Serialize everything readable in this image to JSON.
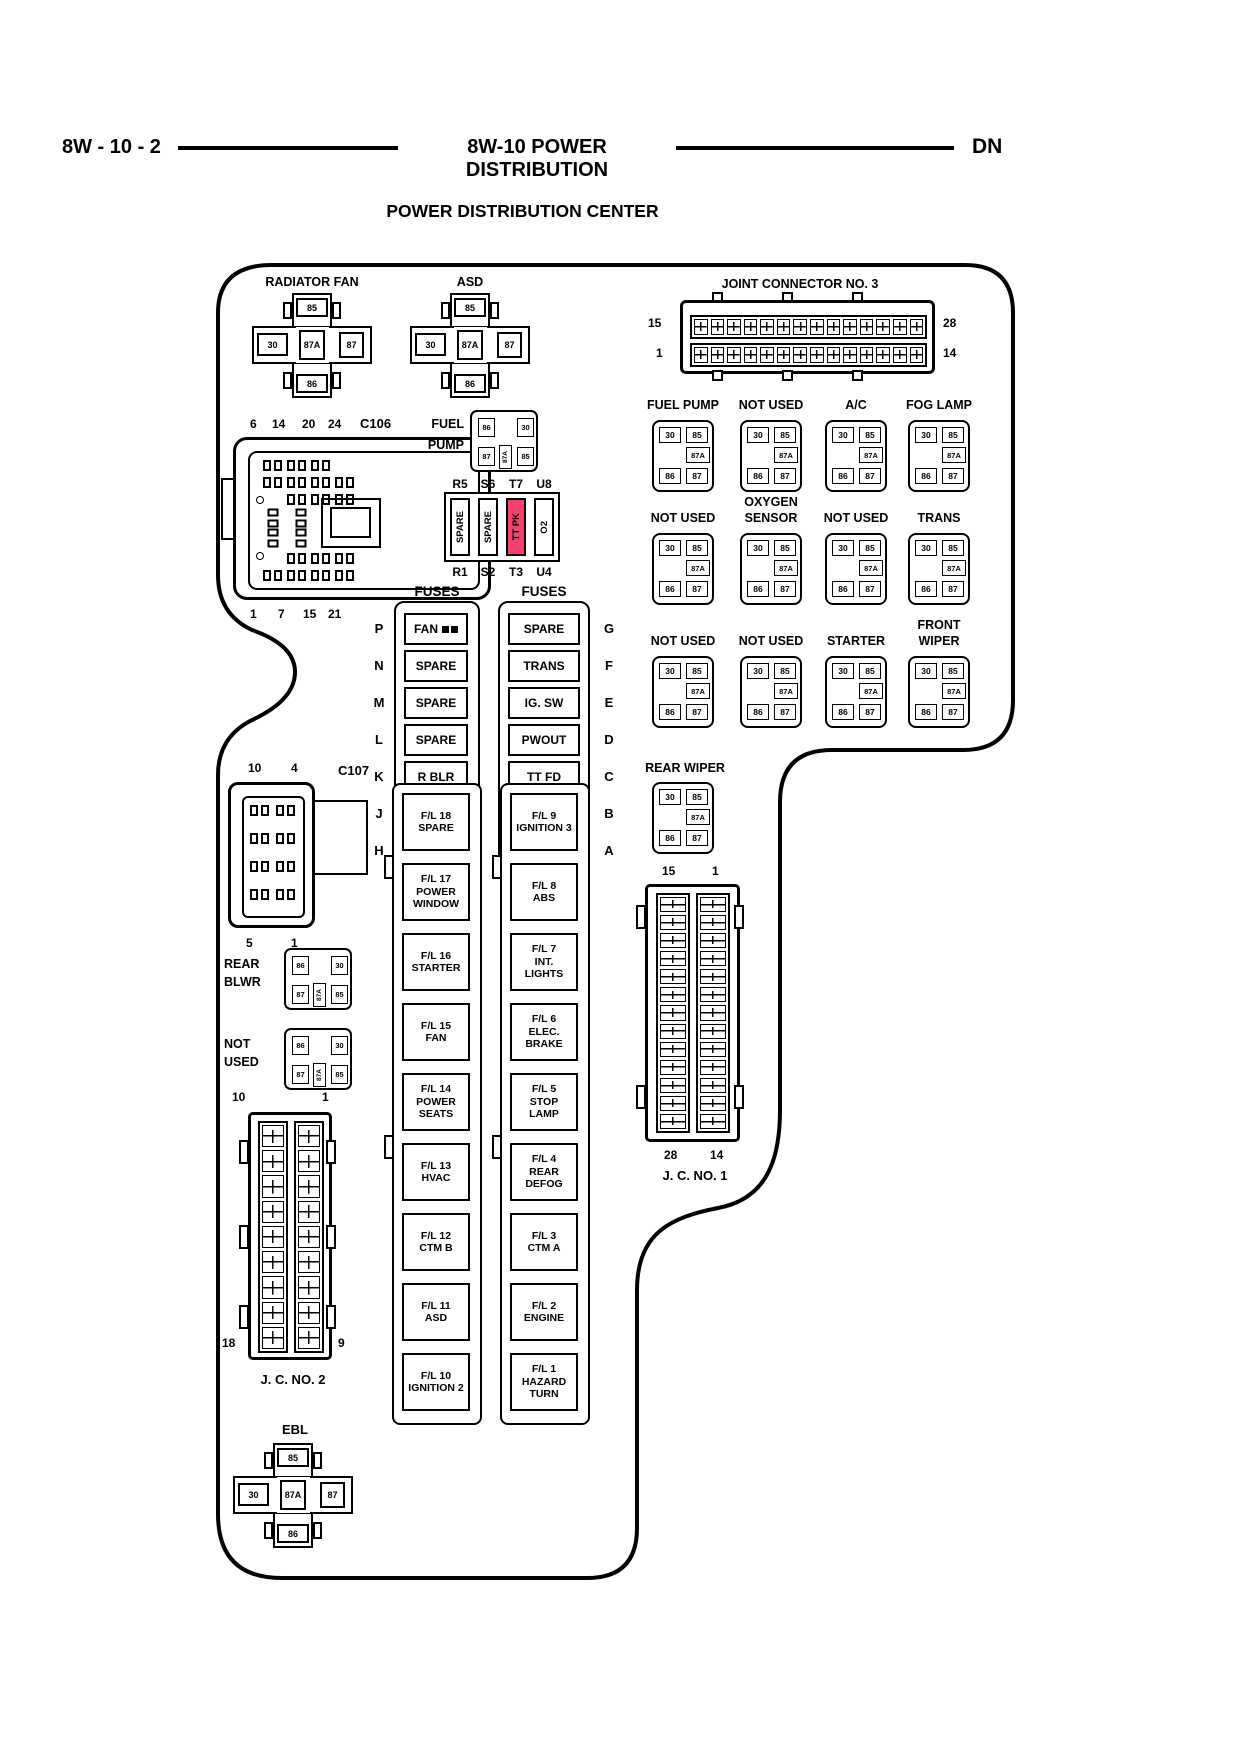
{
  "header": {
    "left_code": "8W - 10 - 2",
    "center_title": "8W-10 POWER DISTRIBUTION",
    "right_code": "DN"
  },
  "title": "POWER DISTRIBUTION CENTER",
  "colors": {
    "highlight_pink": "#f4426e"
  },
  "pins_big": {
    "p85": "85",
    "p30": "30",
    "p87a": "87A",
    "p87": "87",
    "p86": "86"
  },
  "pins_small": {
    "p30": "30",
    "p85": "85",
    "p87a": "87A",
    "p86": "86",
    "p87": "87"
  },
  "pins_mini": {
    "p86": "86",
    "p30": "30",
    "p87": "87",
    "p87a": "87A",
    "p85": "85"
  },
  "big_relays": {
    "radiator_fan": "RADIATOR FAN",
    "asd": "ASD",
    "ebl": "EBL"
  },
  "jc3": {
    "label": "JOINT CONNECTOR NO. 3",
    "top_left": "15",
    "bottom_left": "1",
    "top_right": "28",
    "bottom_right": "14"
  },
  "jc1": {
    "label": "J. C. NO. 1",
    "top_left": "15",
    "top_right": "1",
    "bottom_left": "28",
    "bottom_right": "14"
  },
  "jc2": {
    "label": "J. C. NO. 2",
    "top_left": "10",
    "top_right": "1",
    "bottom_left": "18",
    "bottom_right": "9"
  },
  "c106": {
    "label": "C106",
    "top_pins": [
      "6",
      "14",
      "20",
      "24"
    ],
    "bottom_pins": [
      "1",
      "7",
      "15",
      "21"
    ]
  },
  "c107": {
    "label": "C107",
    "top_pins": [
      "10",
      "4"
    ],
    "bottom_pins": [
      "5",
      "1"
    ]
  },
  "fuel_pump": {
    "line1": "FUEL",
    "line2": "PUMP"
  },
  "rear_blwr": {
    "line1": "REAR",
    "line2": "BLWR"
  },
  "not_used_mini": {
    "line1": "NOT",
    "line2": "USED"
  },
  "mini_strip": {
    "top": [
      "R5",
      "S6",
      "T7",
      "U8"
    ],
    "bottom": [
      "R1",
      "S2",
      "T3",
      "U4"
    ],
    "fuses": [
      "SPARE",
      "SPARE",
      "TT PK",
      "O2"
    ]
  },
  "fuse_columns": {
    "left": {
      "header": "FUSES",
      "rows": [
        {
          "pos": "P",
          "label": "FAN"
        },
        {
          "pos": "N",
          "label": "SPARE"
        },
        {
          "pos": "M",
          "label": "SPARE"
        },
        {
          "pos": "L",
          "label": "SPARE"
        },
        {
          "pos": "K",
          "label": "R BLR"
        },
        {
          "pos": "J",
          "label": "R WPR"
        },
        {
          "pos": "H",
          "label": "FG LP"
        }
      ]
    },
    "right": {
      "header": "FUSES",
      "rows": [
        {
          "pos": "G",
          "label": "SPARE"
        },
        {
          "pos": "F",
          "label": "TRANS"
        },
        {
          "pos": "E",
          "label": "IG. SW"
        },
        {
          "pos": "D",
          "label": "PWOUT"
        },
        {
          "pos": "C",
          "label": "TT FD"
        },
        {
          "pos": "B",
          "label": "A/C"
        },
        {
          "pos": "A",
          "label": "4X4"
        }
      ]
    }
  },
  "relay_grid": {
    "row1": [
      "FUEL PUMP",
      "NOT USED",
      "A/C",
      "FOG LAMP"
    ],
    "row2": [
      "NOT USED",
      "OXYGEN SENSOR",
      "NOT USED",
      "TRANS"
    ],
    "row3": [
      "NOT USED",
      "NOT USED",
      "STARTER",
      "FRONT WIPER"
    ],
    "row4": [
      "REAR WIPER"
    ]
  },
  "fusible_links": {
    "left": [
      {
        "id": "F/L 18",
        "name": "SPARE"
      },
      {
        "id": "F/L 17",
        "name": "POWER WINDOW"
      },
      {
        "id": "F/L 16",
        "name": "STARTER"
      },
      {
        "id": "F/L 15",
        "name": "FAN"
      },
      {
        "id": "F/L 14",
        "name": "POWER SEATS"
      },
      {
        "id": "F/L 13",
        "name": "HVAC"
      },
      {
        "id": "F/L 12",
        "name": "CTM B"
      },
      {
        "id": "F/L 11",
        "name": "ASD"
      },
      {
        "id": "F/L 10",
        "name": "IGNITION 2"
      }
    ],
    "right": [
      {
        "id": "F/L 9",
        "name": "IGNITION 3"
      },
      {
        "id": "F/L 8",
        "name": "ABS"
      },
      {
        "id": "F/L 7",
        "name": "INT. LIGHTS"
      },
      {
        "id": "F/L 6",
        "name": "ELEC. BRAKE"
      },
      {
        "id": "F/L 5",
        "name": "STOP LAMP"
      },
      {
        "id": "F/L 4",
        "name": "REAR DEFOG"
      },
      {
        "id": "F/L 3",
        "name": "CTM A"
      },
      {
        "id": "F/L 2",
        "name": "ENGINE"
      },
      {
        "id": "F/L 1",
        "name": "HAZARD TURN"
      }
    ]
  }
}
